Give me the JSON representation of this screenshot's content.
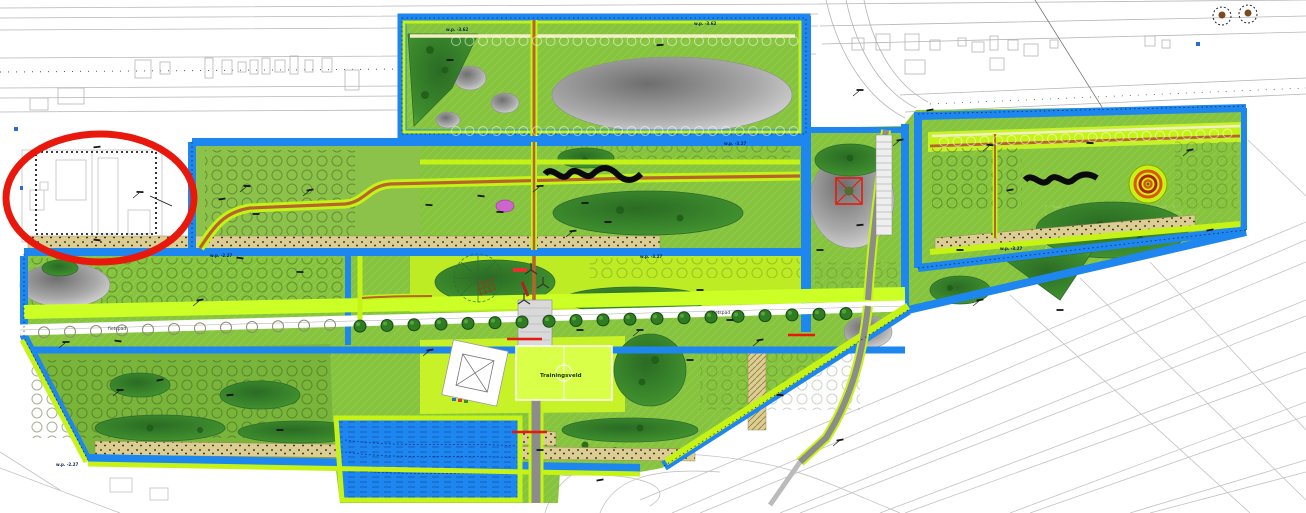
{
  "meta": {
    "type": "landscape-architecture site plan",
    "highlight_note": "red ellipse highlighting building site with dashed demarcation"
  },
  "colors": {
    "water": "#1D86EF",
    "path_lime": "#C6F316",
    "field_green": "#85C43C",
    "olive_green": "#79B53A",
    "bright_field": "#C7F228",
    "trainingsveld_green": "#DAFF48",
    "dark_wood": "#2E7A28",
    "sand": "#DCCE92",
    "path_brown": "#B5642E",
    "road_gray": "#8C8C8C",
    "highlight_red": "#E8190C",
    "marker_red": "#E8190C",
    "flower_magenta": "#CC66CC",
    "spiral_orange": "#E05500",
    "annotation_black": "#151515",
    "cadastral_gray": "#b5b5b5"
  },
  "labels": {
    "trainingsveld": "Trainingsveld",
    "fietspad_left": "fietspad",
    "fietspad_right": "fietspad",
    "wp_top_left": "w.p. -3.62",
    "wp_top_right": "w.p. -3.62",
    "wp_channel_mid": "w.p. -3.27",
    "wp_channel_left": "w.p. -2.27",
    "wp_channel_right": "w.p. -3.27",
    "wp_bottom": "w.p. -2.27",
    "wp_right_section": "w.p. -3.27"
  },
  "red_bridges": [
    [
      507,
      339,
      542
    ],
    [
      788,
      335,
      815
    ],
    [
      512,
      432,
      547
    ]
  ],
  "annotation_marks": [
    [
      247,
      186
    ],
    [
      222,
      199
    ],
    [
      256,
      214
    ],
    [
      310,
      190
    ],
    [
      429,
      205
    ],
    [
      481,
      196
    ],
    [
      540,
      186
    ],
    [
      585,
      203
    ],
    [
      608,
      222
    ],
    [
      573,
      231
    ],
    [
      500,
      212
    ],
    [
      118,
      341
    ],
    [
      66,
      342
    ],
    [
      240,
      258
    ],
    [
      300,
      272
    ],
    [
      200,
      300
    ],
    [
      160,
      380
    ],
    [
      230,
      395
    ],
    [
      120,
      390
    ],
    [
      280,
      430
    ],
    [
      580,
      330
    ],
    [
      640,
      330
    ],
    [
      700,
      290
    ],
    [
      730,
      320
    ],
    [
      760,
      340
    ],
    [
      820,
      250
    ],
    [
      860,
      225
    ],
    [
      900,
      140
    ],
    [
      930,
      110
    ],
    [
      960,
      250
    ],
    [
      990,
      145
    ],
    [
      1010,
      190
    ],
    [
      1090,
      143
    ],
    [
      1190,
      150
    ],
    [
      1210,
      230
    ],
    [
      1060,
      310
    ],
    [
      980,
      300
    ],
    [
      450,
      60
    ],
    [
      660,
      45
    ],
    [
      860,
      90
    ],
    [
      540,
      450
    ],
    [
      600,
      480
    ],
    [
      430,
      350
    ],
    [
      690,
      360
    ],
    [
      780,
      395
    ],
    [
      840,
      440
    ],
    [
      97,
      147
    ],
    [
      97,
      240
    ],
    [
      140,
      192
    ]
  ],
  "tree_rows": [
    {
      "x0": 456,
      "x1": 795,
      "step": 13.5,
      "y": 41,
      "slope": 0
    },
    {
      "x0": 456,
      "x1": 795,
      "step": 13.5,
      "y": 131,
      "slope": 0
    },
    {
      "x0": 944,
      "x1": 1230,
      "step": 13.5,
      "y": 142,
      "slope": -0.03
    }
  ],
  "avenue": {
    "bare_trees": {
      "count": 12,
      "x0": 44,
      "dx": 26
    },
    "green_trees": {
      "count": 19,
      "x0": 360,
      "dx": 27
    },
    "y0": 333,
    "slope": -0.026
  }
}
